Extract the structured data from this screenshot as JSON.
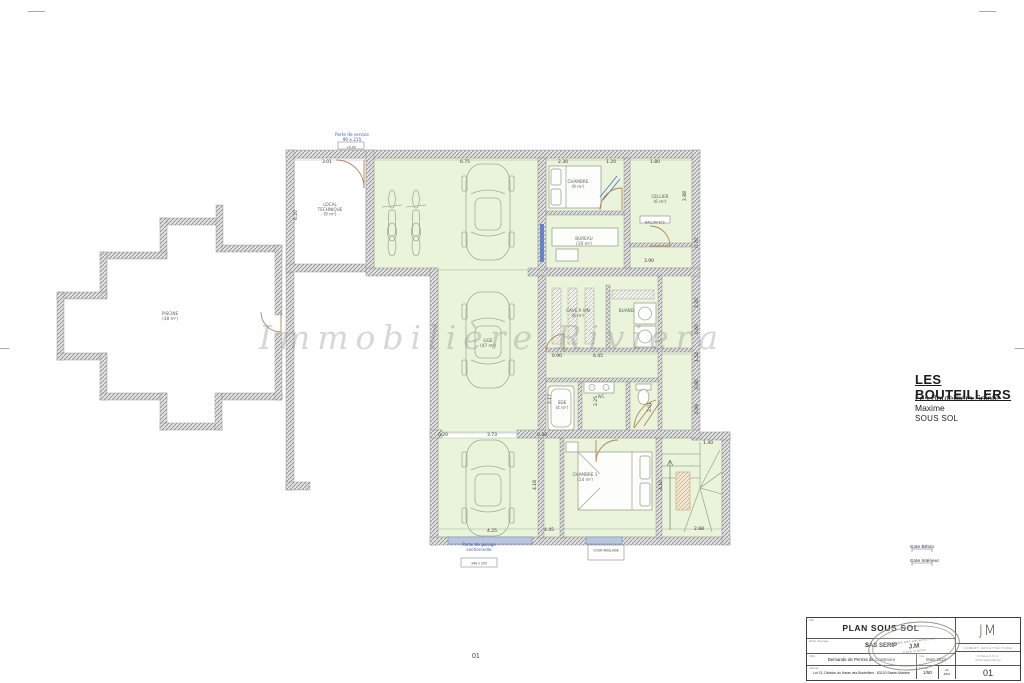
{
  "project": {
    "title": "LES BOUTEILLERS",
    "subtitle": "Les Bouteilliers Sainte Maxime",
    "level": "SOUS SOL"
  },
  "watermark": "Immobilière Riviera",
  "sheet_center": "01",
  "legend": {
    "items": [
      {
        "label": "Cote Béton",
        "color": "#9b8ec4"
      },
      {
        "label": "Cote Intérieur",
        "color": "#9aa0a8"
      }
    ]
  },
  "title_block": {
    "field1_label": "Plan",
    "title": "PLAN SOUS SOL",
    "field2_label": "Maître d'ouvrage",
    "client": "SAS SERIP",
    "field3_label": "Objet",
    "objet": "Demande de Permis de Construire",
    "field4_label": "Adresse",
    "address": "Lot 13, Division du Haras des Bouteillers - 83120 Sainte-Maxime",
    "date_label": "Date",
    "date": "Mars 2023",
    "scale_label": "Échelle",
    "scale": "1/50",
    "format": "A1",
    "format_year": "2013",
    "sheet": "01",
    "logo_text": "JM",
    "logo_subtitle": "JUBERT ARCHITECTURE",
    "logo_line1": "Architecte D.P.L.G.",
    "logo_line2": "83120 Sainte-Maxime",
    "stamp_top": "ORDRE DES ARCHITECTES",
    "stamp_center": "J.M",
    "stamp_bottom": "CÔTE D'AZUR"
  },
  "plan": {
    "room_labels": [
      {
        "lines": [
          "LOCAL",
          "TECHNIQUE",
          "(9 m²)"
        ],
        "x": 330,
        "y": 206
      },
      {
        "lines": [
          "CHAMBRE",
          "(9 m²)"
        ],
        "x": 578,
        "y": 183
      },
      {
        "lines": [
          "BUREAU",
          "(10 m²)"
        ],
        "x": 584,
        "y": 240
      },
      {
        "lines": [
          "CELLIER",
          "(6 m²)"
        ],
        "x": 660,
        "y": 198
      },
      {
        "lines": [
          "GGE",
          "(47 m²)"
        ],
        "x": 488,
        "y": 342
      },
      {
        "lines": [
          "CAVE À VIN",
          "(8 m²)"
        ],
        "x": 578,
        "y": 312
      },
      {
        "lines": [
          "BUAND."
        ],
        "x": 627,
        "y": 312
      },
      {
        "lines": [
          "SDE",
          "(4 m²)"
        ],
        "x": 562,
        "y": 404
      },
      {
        "lines": [
          "WC"
        ],
        "x": 601,
        "y": 398
      },
      {
        "lines": [
          "CHAMBRE 1",
          "(14 m²)"
        ],
        "x": 585,
        "y": 476
      },
      {
        "lines": [
          "PISCINE",
          "(38 m²)"
        ],
        "x": 170,
        "y": 315
      }
    ],
    "dimensions": [
      {
        "t": "3.01",
        "x": 327,
        "y": 163,
        "r": 0
      },
      {
        "t": "6.75",
        "x": 465,
        "y": 163,
        "r": 0
      },
      {
        "t": "2.30",
        "x": 563,
        "y": 163,
        "r": 0
      },
      {
        "t": "1.20",
        "x": 611,
        "y": 163,
        "r": 0
      },
      {
        "t": "1.80",
        "x": 655,
        "y": 163,
        "r": 0
      },
      {
        "t": "6.20",
        "x": 297,
        "y": 215,
        "r": -90
      },
      {
        "t": "2.88",
        "x": 686,
        "y": 196,
        "r": -90
      },
      {
        "t": "3.90",
        "x": 649,
        "y": 262,
        "r": 0
      },
      {
        "t": "6.45",
        "x": 598,
        "y": 357,
        "r": 0
      },
      {
        "t": "0.90",
        "x": 557,
        "y": 357,
        "r": 0
      },
      {
        "t": "2.17",
        "x": 551,
        "y": 399,
        "r": -90
      },
      {
        "t": "2.25",
        "x": 597,
        "y": 401,
        "r": -90
      },
      {
        "t": "0.70",
        "x": 698,
        "y": 243,
        "r": -90
      },
      {
        "t": "1.20",
        "x": 698,
        "y": 303,
        "r": -90
      },
      {
        "t": "0.60",
        "x": 698,
        "y": 329,
        "r": -90
      },
      {
        "t": "1.54",
        "x": 698,
        "y": 357,
        "r": -90
      },
      {
        "t": "0.60",
        "x": 698,
        "y": 384,
        "r": -90
      },
      {
        "t": "0.99",
        "x": 698,
        "y": 409,
        "r": -90
      },
      {
        "t": "2.01",
        "x": 651,
        "y": 407,
        "r": -90
      },
      {
        "t": "0.20",
        "x": 443,
        "y": 436,
        "r": 0
      },
      {
        "t": "3.73",
        "x": 492,
        "y": 436,
        "r": 0
      },
      {
        "t": "0.30",
        "x": 542,
        "y": 436,
        "r": 0
      },
      {
        "t": "1.40",
        "x": 708,
        "y": 444,
        "r": 0
      },
      {
        "t": "4.25",
        "x": 492,
        "y": 532,
        "r": 0
      },
      {
        "t": "4.45",
        "x": 549,
        "y": 531,
        "r": 0
      },
      {
        "t": "2.88",
        "x": 699,
        "y": 530,
        "r": 0
      },
      {
        "t": "4.18",
        "x": 536,
        "y": 485,
        "r": -90
      },
      {
        "t": "4.10",
        "x": 662,
        "y": 485,
        "r": -90
      }
    ],
    "annotations": [
      {
        "lines": [
          "Porte de service",
          "90 x 215"
        ],
        "x": 352,
        "y": 136
      },
      {
        "lines": [
          "Porte de garage",
          "sectionnelle"
        ],
        "x": 479,
        "y": 546
      }
    ],
    "boxed_labels": [
      {
        "text": "+0,00",
        "x": 351,
        "y": 146,
        "w": 26,
        "h": 7
      },
      {
        "text": "240 x 200",
        "x": 479,
        "y": 562,
        "w": 36,
        "h": 9
      },
      {
        "text": "BALLON ECS",
        "x": 655,
        "y": 221,
        "w": 30,
        "h": 7
      },
      {
        "text": "COUR ANGLAISE",
        "x": 606,
        "y": 549,
        "w": 34,
        "h": 9
      }
    ]
  }
}
